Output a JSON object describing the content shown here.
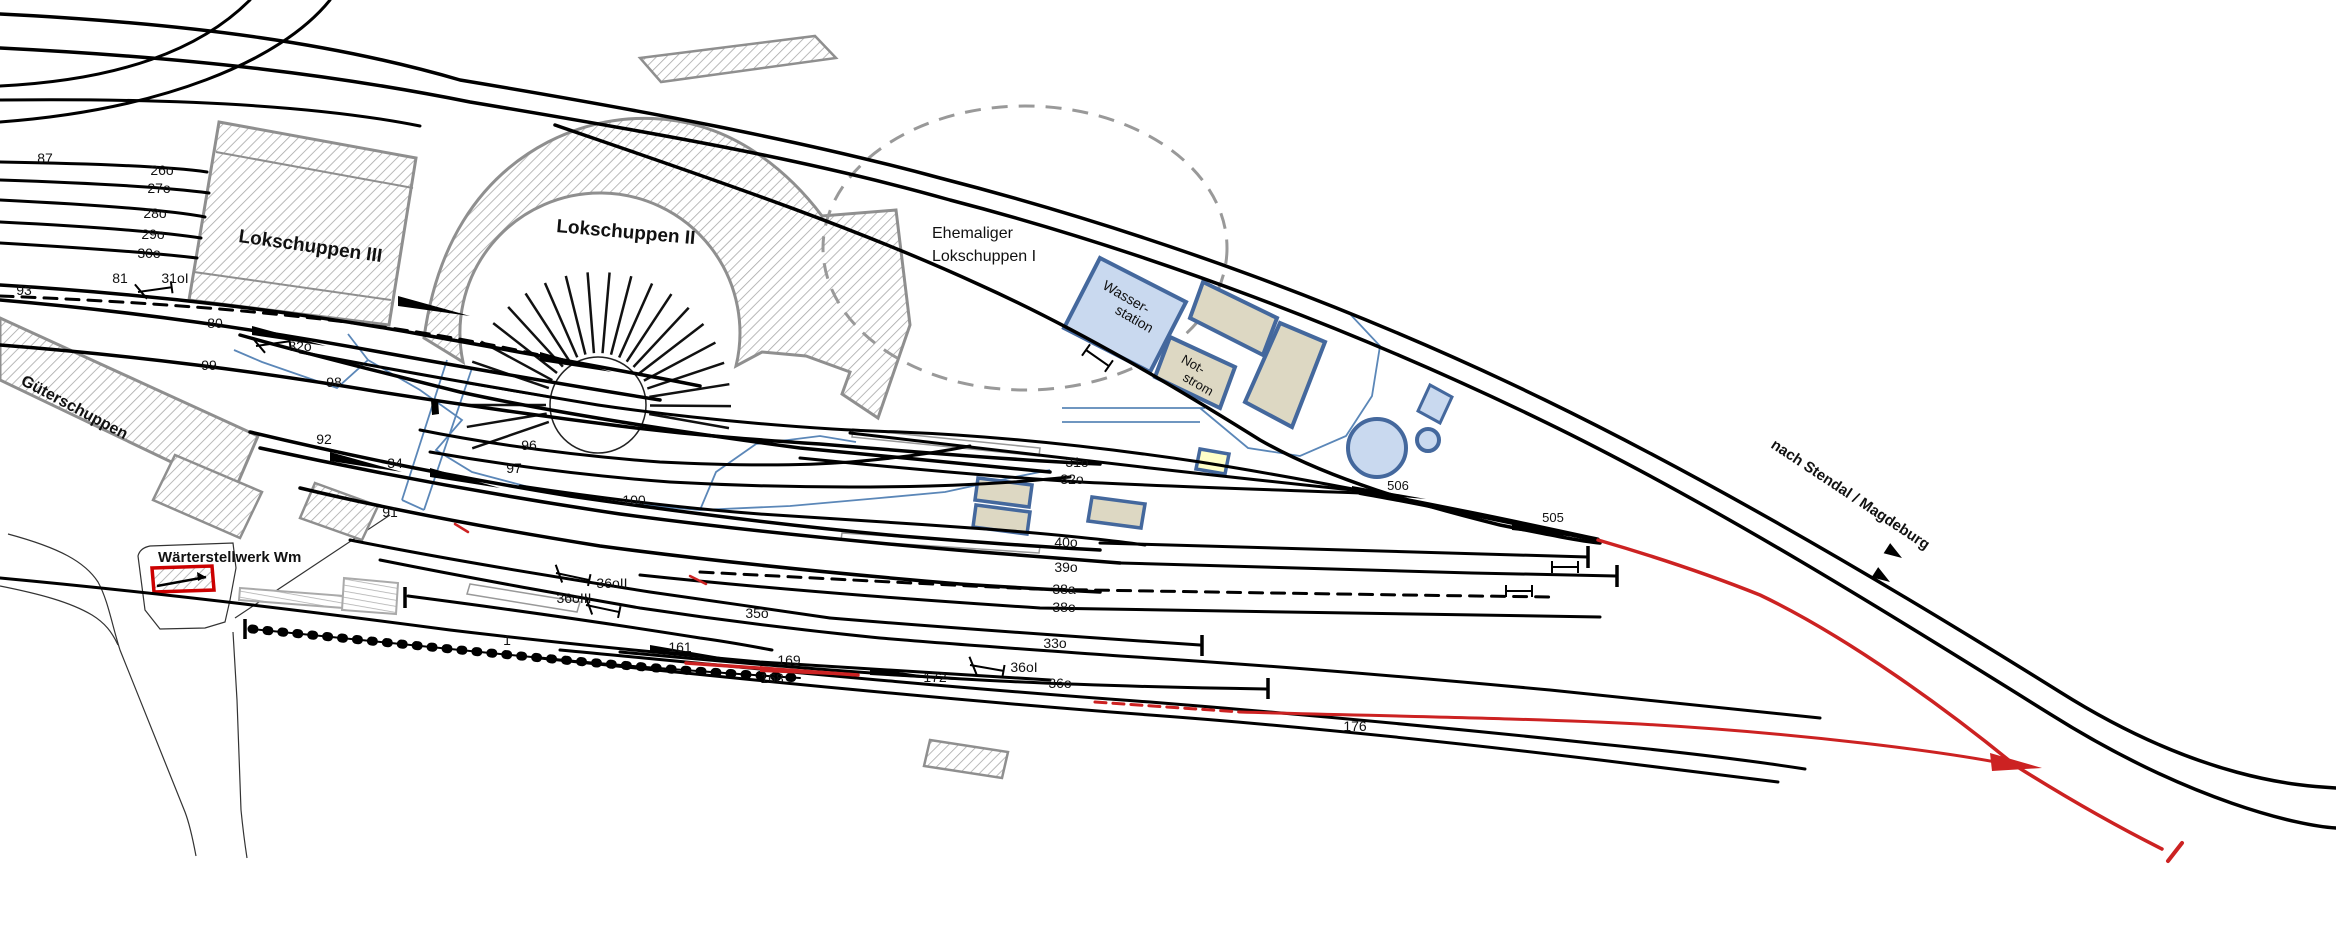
{
  "diagram": {
    "type": "railway-track-plan",
    "colors": {
      "track_black": "#000000",
      "highlight_red": "#cc2222",
      "building_border_gray": "#8f8f8f",
      "blue_border": "#44689d",
      "blue_fill": "#c9d9ef",
      "tan_fill": "#ddd8c3",
      "yellow_fill": "#ffffc9",
      "dashed_outline_gray": "#999999"
    },
    "buildings": [
      {
        "name": "lokschuppen-3",
        "label": "Lokschuppen III"
      },
      {
        "name": "lokschuppen-2",
        "label": "Lokschuppen II"
      },
      {
        "name": "ehemaliger-lokschuppen-1",
        "label": "Ehemaliger Lokschuppen I"
      },
      {
        "name": "wasserstation",
        "label": "Wasser- station"
      },
      {
        "name": "notstrom",
        "label": "Not- strom"
      },
      {
        "name": "gueterschuppen",
        "label": "Güterschuppen"
      },
      {
        "name": "waerterstellwerk",
        "label": "Wärterstellwerk Wm"
      }
    ],
    "route_label": "nach Stendal / Magdeburg",
    "labels": [
      {
        "name": "track-label-87",
        "text": "87",
        "x": 45,
        "y": 163
      },
      {
        "name": "track-label-26o",
        "text": "26o",
        "x": 162,
        "y": 175
      },
      {
        "name": "track-label-27o",
        "text": "27o",
        "x": 159,
        "y": 193
      },
      {
        "name": "track-label-28o",
        "text": "28o",
        "x": 155,
        "y": 218
      },
      {
        "name": "track-label-29o",
        "text": "29o",
        "x": 153,
        "y": 239
      },
      {
        "name": "track-label-30o",
        "text": "30o",
        "x": 149,
        "y": 258
      },
      {
        "name": "track-label-93",
        "text": "93",
        "x": 24,
        "y": 295
      },
      {
        "name": "track-label-81",
        "text": "81",
        "x": 120,
        "y": 283
      },
      {
        "name": "signal-label-31oI",
        "text": "31oI",
        "x": 175,
        "y": 283
      },
      {
        "name": "track-label-80",
        "text": "80",
        "x": 215,
        "y": 328
      },
      {
        "name": "signal-label-32o-west",
        "text": "32o",
        "x": 300,
        "y": 351
      },
      {
        "name": "track-label-99",
        "text": "99",
        "x": 209,
        "y": 370
      },
      {
        "name": "track-label-98",
        "text": "98",
        "x": 334,
        "y": 387
      },
      {
        "name": "track-label-92",
        "text": "92",
        "x": 324,
        "y": 444
      },
      {
        "name": "track-label-34",
        "text": "34",
        "x": 395,
        "y": 468
      },
      {
        "name": "track-label-91",
        "text": "91",
        "x": 390,
        "y": 517
      },
      {
        "name": "track-label-96",
        "text": "96",
        "x": 529,
        "y": 450
      },
      {
        "name": "track-label-97",
        "text": "97",
        "x": 514,
        "y": 473
      },
      {
        "name": "track-label-100",
        "text": "100",
        "x": 634,
        "y": 505
      },
      {
        "name": "track-label-31o",
        "text": "31o",
        "x": 1077,
        "y": 467
      },
      {
        "name": "track-label-32o",
        "text": "32o",
        "x": 1072,
        "y": 484
      },
      {
        "name": "track-label-40o",
        "text": "40o",
        "x": 1066,
        "y": 547
      },
      {
        "name": "track-label-39o",
        "text": "39o",
        "x": 1066,
        "y": 572
      },
      {
        "name": "track-label-38a",
        "text": "38a",
        "x": 1064,
        "y": 594
      },
      {
        "name": "track-label-38o",
        "text": "38o",
        "x": 1064,
        "y": 612
      },
      {
        "name": "track-label-35o",
        "text": "35o",
        "x": 757,
        "y": 618
      },
      {
        "name": "track-label-1",
        "text": "1",
        "x": 507,
        "y": 645
      },
      {
        "name": "track-label-161",
        "text": "161",
        "x": 680,
        "y": 652
      },
      {
        "name": "track-label-169",
        "text": "169",
        "x": 789,
        "y": 665
      },
      {
        "name": "track-label-168",
        "text": "168",
        "x": 772,
        "y": 683,
        "color": "#cc2222"
      },
      {
        "name": "track-label-172",
        "text": "172",
        "x": 935,
        "y": 682
      },
      {
        "name": "track-label-33o",
        "text": "33o",
        "x": 1055,
        "y": 648
      },
      {
        "name": "signal-label-36oI",
        "text": "36oI",
        "x": 1024,
        "y": 672
      },
      {
        "name": "track-label-36o",
        "text": "36o",
        "x": 1060,
        "y": 688
      },
      {
        "name": "signal-label-36oII",
        "text": "36oII",
        "x": 612,
        "y": 588
      },
      {
        "name": "signal-label-36oIII",
        "text": "36oIII",
        "x": 574,
        "y": 603
      },
      {
        "name": "track-label-176",
        "text": "176",
        "x": 1355,
        "y": 731,
        "color": "#cc2222"
      },
      {
        "name": "switch-label-505",
        "text": "505",
        "x": 1553,
        "y": 522,
        "size": 13
      },
      {
        "name": "switch-label-506",
        "text": "506",
        "x": 1398,
        "y": 490,
        "size": 13
      },
      {
        "name": "route-label-stendal-magdeburg",
        "text": "nach Stendal / Magdeburg",
        "x": 1770,
        "y": 447,
        "rot": 33.5,
        "size": 15,
        "bold": true,
        "anchor": "start"
      },
      {
        "name": "building-label-waerterstellwerk",
        "text": "Wärterstellwerk Wm",
        "x": 158,
        "y": 562,
        "size": 15,
        "bold": true,
        "anchor": "start"
      },
      {
        "name": "building-label-lokschuppen-3",
        "text": "Lokschuppen III",
        "x": 238,
        "y": 242,
        "rot": 8,
        "size": 19,
        "bold": true,
        "anchor": "start"
      },
      {
        "name": "building-label-lokschuppen-2",
        "text": "Lokschuppen II",
        "x": 556,
        "y": 232,
        "rot": 5,
        "size": 19,
        "bold": true,
        "anchor": "start"
      },
      {
        "name": "building-label-ehemaliger-line1",
        "text": "Ehemaliger",
        "x": 932,
        "y": 238,
        "size": 16,
        "anchor": "start"
      },
      {
        "name": "building-label-ehemaliger-line2",
        "text": "Lokschuppen I",
        "x": 932,
        "y": 261,
        "size": 16,
        "anchor": "start"
      },
      {
        "name": "building-label-wasserstation-line1",
        "text": "Wasser-",
        "x": 1124,
        "y": 301,
        "rot": 30,
        "size": 14
      },
      {
        "name": "building-label-wasserstation-line2",
        "text": "station",
        "x": 1132,
        "y": 323,
        "rot": 30,
        "size": 14
      },
      {
        "name": "building-label-notstrom-line1",
        "text": "Not-",
        "x": 1191,
        "y": 368,
        "rot": 30,
        "size": 13
      },
      {
        "name": "building-label-notstrom-line2",
        "text": "strom",
        "x": 1196,
        "y": 388,
        "rot": 30,
        "size": 13
      },
      {
        "name": "building-label-gueterschuppen",
        "text": "Güterschuppen",
        "x": 20,
        "y": 384,
        "rot": 28,
        "size": 16,
        "bold": true,
        "anchor": "start"
      }
    ]
  }
}
